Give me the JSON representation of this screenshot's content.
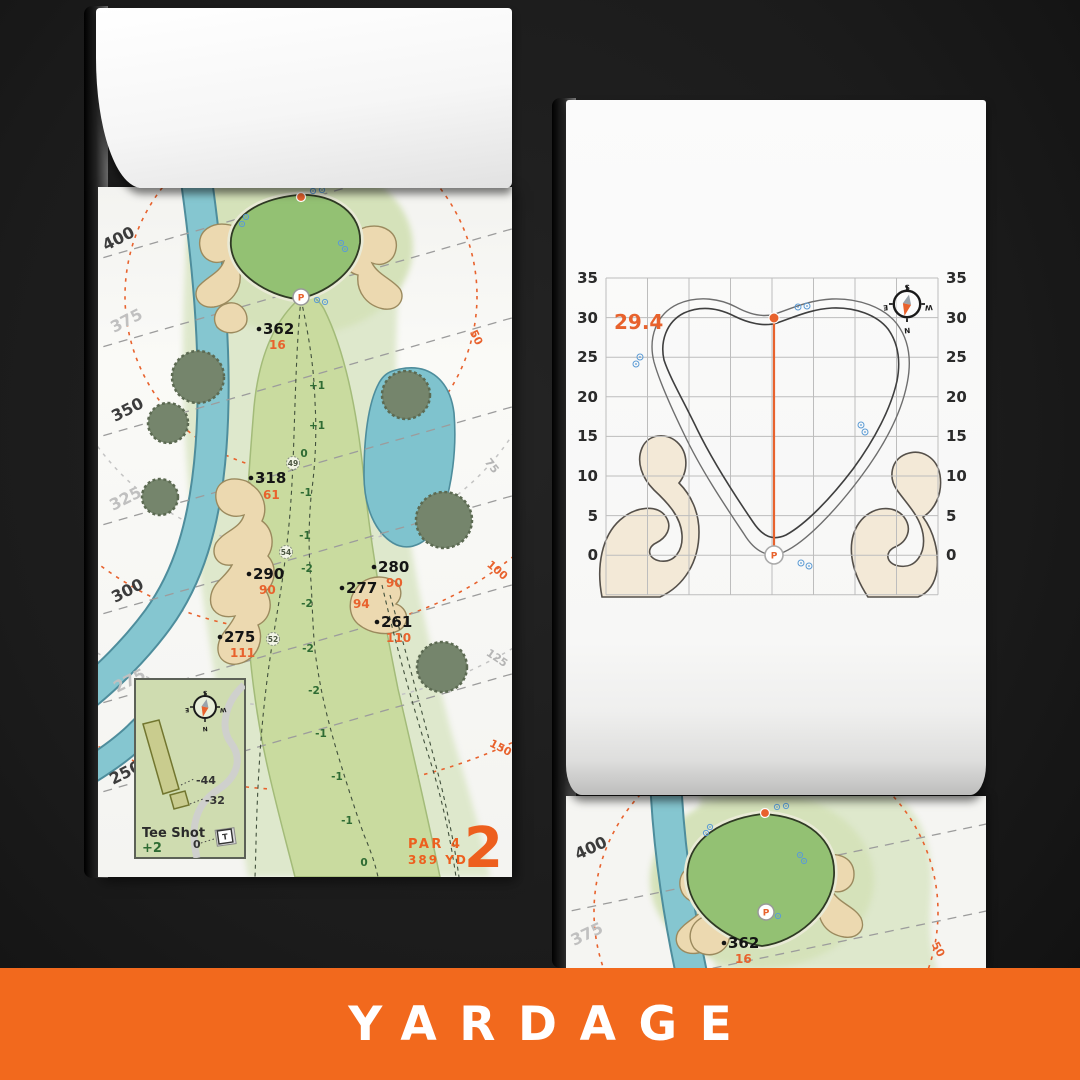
{
  "banner": {
    "title": "YARDAGE"
  },
  "left_page": {
    "yardage_labels": [
      "400",
      "375",
      "350",
      "325",
      "300",
      "275",
      "250"
    ],
    "arc_labels": [
      "50",
      "75",
      "100",
      "125",
      "150"
    ],
    "carries": [
      {
        "main": "362",
        "sub": "16"
      },
      {
        "main": "318",
        "sub": "61"
      },
      {
        "main": "290",
        "sub": "90"
      },
      {
        "main": "275",
        "sub": "111"
      },
      {
        "main": "280",
        "sub": "90"
      },
      {
        "main": "277",
        "sub": "94"
      },
      {
        "main": "261",
        "sub": "110"
      }
    ],
    "slopes": [
      "+1",
      "+1",
      "0",
      "-1",
      "-1",
      "-2",
      "-2",
      "-2",
      "-2",
      "-1",
      "-1",
      "-1",
      "0"
    ],
    "circles": [
      "49",
      "54",
      "52"
    ],
    "pin": "P",
    "inset": {
      "title": "Tee Shot",
      "score": "+2",
      "zero": "0",
      "offsets": [
        "-44",
        "-32"
      ],
      "tee_marker": "T",
      "compass": {
        "n": "N",
        "s": "S",
        "e": "E",
        "w": "W"
      }
    },
    "hole": {
      "par": "PAR 4",
      "yardage": "389 YD",
      "number": "2"
    }
  },
  "right_page": {
    "measurement": "29.4",
    "axis_values": [
      "35",
      "30",
      "25",
      "20",
      "15",
      "10",
      "5",
      "0"
    ],
    "pin": "P",
    "compass": {
      "n": "N",
      "s": "S",
      "e": "E",
      "w": "W"
    }
  },
  "bottom_page": {
    "yardage_labels": [
      "400",
      "375"
    ],
    "carry": {
      "main": "362",
      "sub": "16"
    },
    "arc_label": "50"
  },
  "colors": {
    "accent_orange": "#f2691d",
    "map_orange": "#e8622d",
    "water": "#85c6d0",
    "sand": "#ecd9b0",
    "green_fill": "#93c173"
  }
}
